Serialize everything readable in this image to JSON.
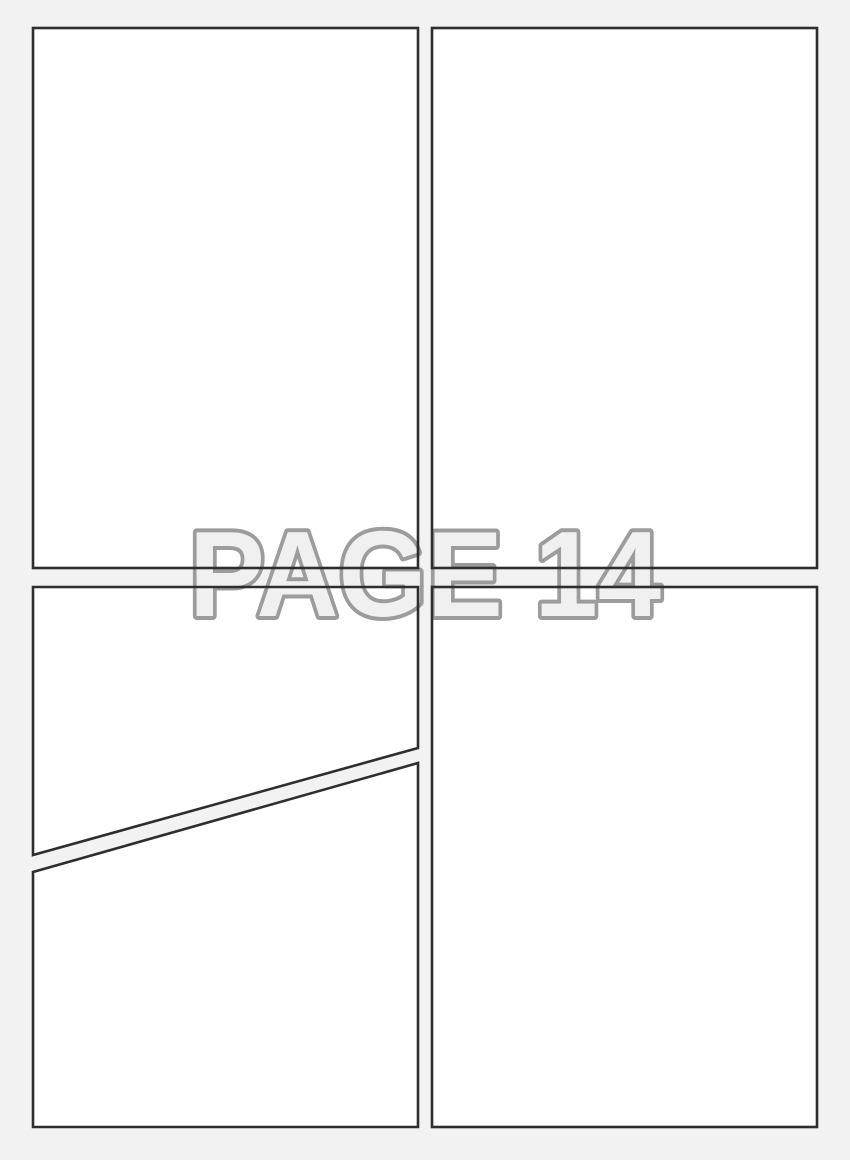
{
  "page": {
    "watermark": "PAGE 14"
  },
  "colors": {
    "background": "#f2f2f2",
    "panel_fill": "#ffffff",
    "panel_border": "#2e2e2e",
    "watermark_fill": "#f0f0f0",
    "watermark_outline": "#9c9c9c"
  }
}
